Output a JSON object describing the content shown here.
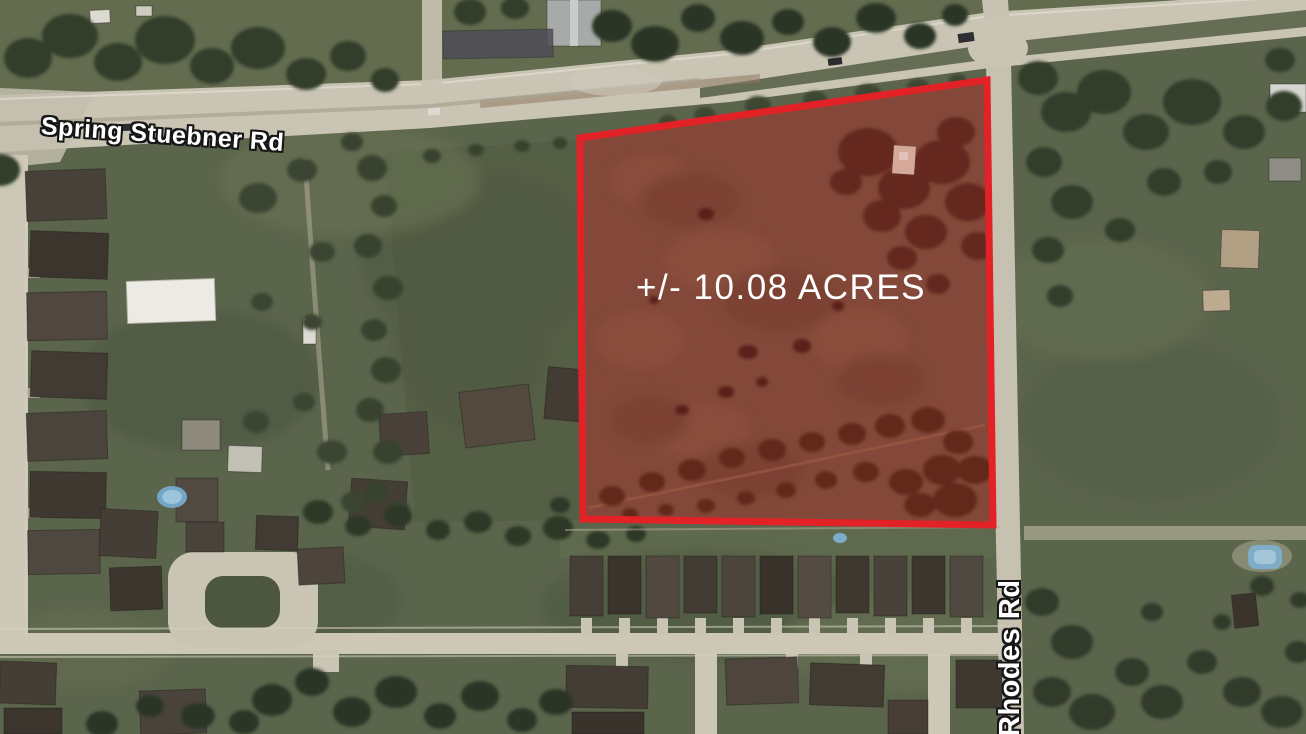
{
  "map": {
    "labels": {
      "spring_stuebner_rd": "Spring Stuebner Rd",
      "rhodes_rd": "Rhodes Rd"
    },
    "parcel": {
      "area_label": "+/- 10.08 ACRES",
      "area_acres": 10.08,
      "outline_color": "#e32227",
      "label_color": "#ffffff"
    }
  }
}
